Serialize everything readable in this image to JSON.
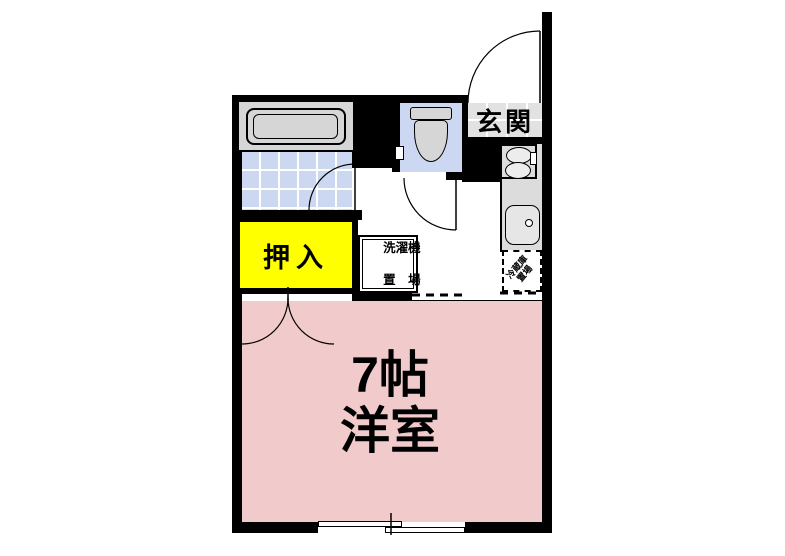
{
  "floorplan": {
    "type": "japanese-apartment-floor-plan",
    "labels": {
      "entrance": "玄関",
      "closet": "押入",
      "laundry_line1": "洗濯機",
      "laundry_line2": "置　場",
      "refrigerator_line1": "冷蔵庫",
      "refrigerator_line2": "置場",
      "room_size": "7帖",
      "room_type": "洋室"
    },
    "rooms": [
      {
        "name": "western-room",
        "label": "7帖 洋室",
        "color": "#f1cbcb"
      },
      {
        "name": "closet-oshiire",
        "label": "押入",
        "color": "#ffff00"
      },
      {
        "name": "bathroom",
        "label": "",
        "color": "#ccd8f2"
      },
      {
        "name": "toilet",
        "label": "",
        "color": "#ccd8f2"
      },
      {
        "name": "entrance-genkan",
        "label": "玄関",
        "color": "#e2e2e2"
      },
      {
        "name": "kitchen-counter",
        "label": "",
        "color": "#dcdcdc"
      }
    ],
    "colors": {
      "wall": "#000000",
      "room_pink": "#f1cbcb",
      "closet_yellow": "#ffff00",
      "tile_blue": "#ccd8f2",
      "entrance_gray": "#e2e2e2",
      "counter_gray": "#dcdcdc",
      "fixture_gray": "#d6d6d6",
      "background": "#ffffff"
    }
  }
}
